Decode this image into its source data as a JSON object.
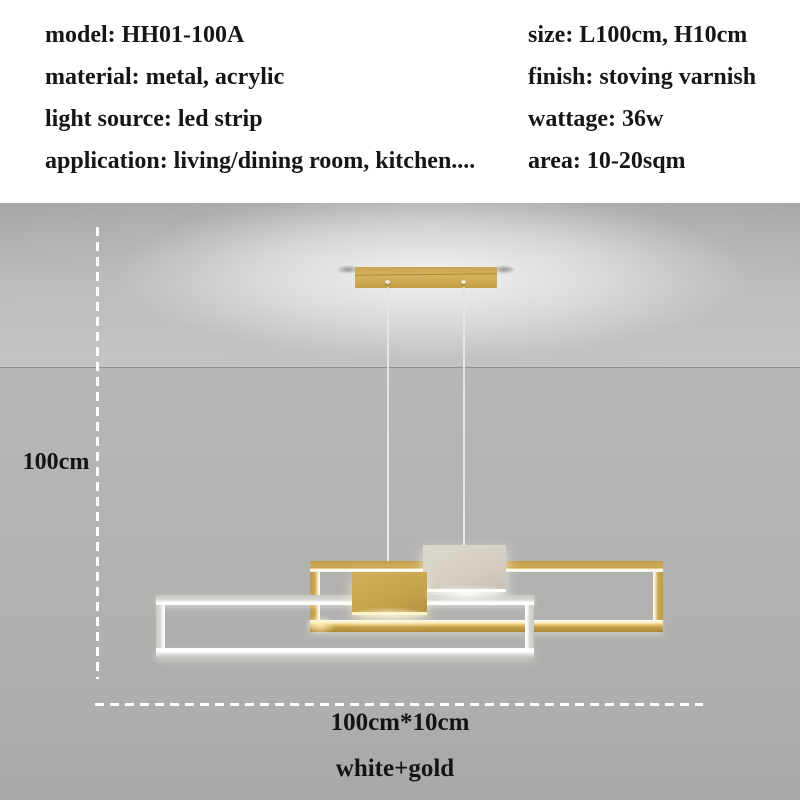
{
  "specs": {
    "left": [
      "model: HH01-100A",
      "material: metal, acrylic",
      "light source: led strip",
      "application: living/dining room, kitchen...."
    ],
    "right": [
      "size: L100cm, H10cm",
      "finish: stoving varnish",
      "wattage: 36w",
      "area: 10-20sqm"
    ]
  },
  "annotations": {
    "drop_height": "100cm",
    "fixture_size": "100cm*10cm",
    "color_variant": "white+gold"
  },
  "colors": {
    "gold_metal": "#c9a64f",
    "gold_glow": "#fdf2c6",
    "led_glow": "#ffffff",
    "white_metal": "#d5cfc4",
    "wall_grey": "#b1b1b0",
    "ceiling_glow": "#f0f0ee",
    "text": "#161616",
    "dimension_line": "#ffffff"
  }
}
